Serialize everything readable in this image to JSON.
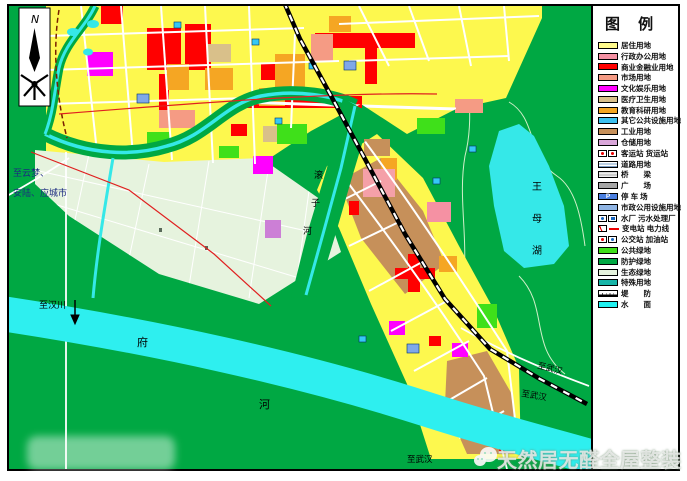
{
  "legend": {
    "title": "图 例",
    "items": [
      {
        "label": "居住用地",
        "type": "color",
        "color": "#FFFB8C"
      },
      {
        "label": "行政办公用地",
        "type": "color",
        "color": "#F591A3"
      },
      {
        "label": "商业金融业用地",
        "type": "color",
        "color": "#FF0000"
      },
      {
        "label": "市场用地",
        "type": "color",
        "color": "#F59B84"
      },
      {
        "label": "文化娱乐用地",
        "type": "color",
        "color": "#FF00FF"
      },
      {
        "label": "医疗卫生用地",
        "type": "color",
        "color": "#D9C08A"
      },
      {
        "label": "教育科研用地",
        "type": "color",
        "color": "#F5A623"
      },
      {
        "label": "其它公共设施用地",
        "type": "color",
        "color": "#3EC1F0"
      },
      {
        "label": "工业用地",
        "type": "color",
        "color": "#C6905A"
      },
      {
        "label": "仓储用地",
        "type": "color",
        "color": "#D9A6D9"
      },
      {
        "label": "客运站 货运站",
        "type": "station-icons"
      },
      {
        "label": "道路用地",
        "type": "road-hatch"
      },
      {
        "label": "桥　　梁",
        "type": "bridge"
      },
      {
        "label": "广　　场",
        "type": "color",
        "color": "#A6A6A6"
      },
      {
        "label": "停 车 场",
        "type": "parking",
        "letter": "P",
        "color": "#4A7FE0"
      },
      {
        "label": "市政公用设施用地",
        "type": "color",
        "color": "#8FB4E3"
      },
      {
        "label": "水厂 污水处理厂",
        "type": "plant-icons"
      },
      {
        "label": "变电站 电力线",
        "type": "power-icons"
      },
      {
        "label": "公交站 加油站",
        "type": "bus-icons"
      },
      {
        "label": "公共绿地",
        "type": "color",
        "color": "#3FE01A"
      },
      {
        "label": "防护绿地",
        "type": "color",
        "color": "#00A843"
      },
      {
        "label": "生态绿地",
        "type": "color",
        "color": "#E6F3DE"
      },
      {
        "label": "特殊用地",
        "type": "color",
        "color": "#18B5A8"
      },
      {
        "label": "堤　　防",
        "type": "dike"
      },
      {
        "label": "水　　面",
        "type": "color",
        "color": "#20F0F0"
      }
    ]
  },
  "map": {
    "north_label": "N",
    "labels": {
      "to_yunmeng_1": "至云梦、",
      "to_yunmeng_2": "安陆、应城市",
      "to_hanchuan": "至汉川",
      "fu_river": [
        "府",
        "河"
      ],
      "wangmu_lake": [
        "王",
        "母",
        "湖"
      ],
      "gunzi_river": [
        "滚",
        "子",
        "河"
      ],
      "to_wuhan_rail": "至武汉",
      "to_wuhan_road": "至武汉",
      "to_wuhan_south": "至武汉"
    }
  },
  "watermark": {
    "text": "天然居无醛全屋整装"
  },
  "colors": {
    "residential": "#FDF84E",
    "commercial": "#FF0000",
    "admin_office": "#F591A3",
    "market": "#F59B84",
    "culture": "#FF00FF",
    "medical": "#D9C08A",
    "education": "#F5A623",
    "public_facility": "#35C8F5",
    "industry": "#C6905A",
    "warehouse": "#CC7FD6",
    "municipal": "#7FA8E8",
    "public_green": "#3FE01A",
    "protective_green": "#00A843",
    "eco_green": "#E6F3DE",
    "water": "#35E8E8",
    "road": "#FFFFFF",
    "railway": "#000000",
    "power_line": "#E02020"
  }
}
